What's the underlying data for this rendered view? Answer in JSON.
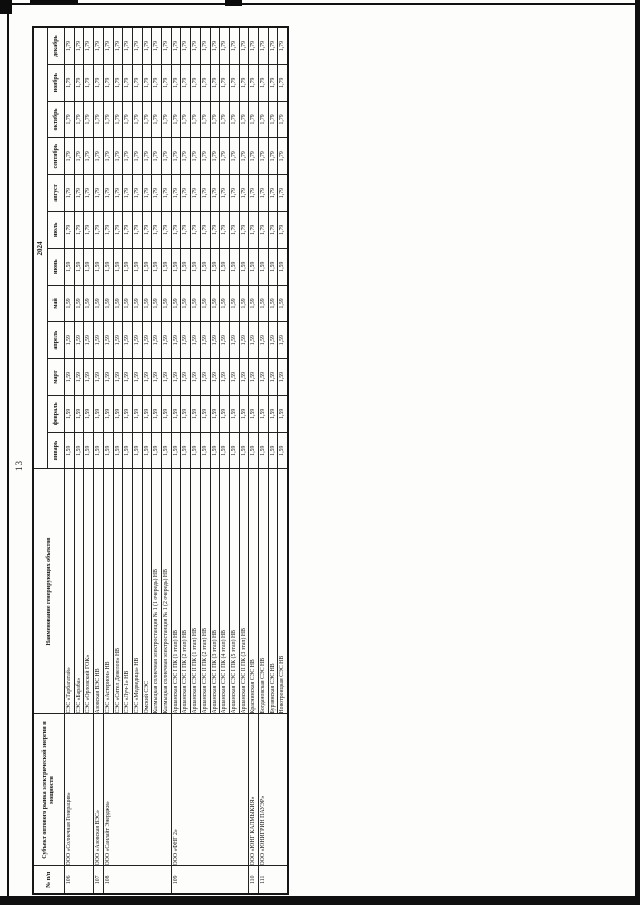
{
  "page": {
    "number": "13"
  },
  "table": {
    "year_header": "2024",
    "column_headers": {
      "num": "№ п/п",
      "subject": "Субъект оптового рынка электрической энергии и мощности",
      "object": "Наименование генерирующих объектов"
    },
    "months": [
      "январь",
      "февраль",
      "март",
      "апрель",
      "май",
      "июнь",
      "июль",
      "август",
      "сентябрь",
      "октябрь",
      "ноябрь",
      "декабрь"
    ],
    "groups": [
      {
        "no": "106",
        "subject": "ООО «Солнечная Генерация»",
        "objects": [
          {
            "name": "СЭС «Тарбагатай»",
            "values": [
              "1,59",
              "1,59",
              "1,59",
              "1,59",
              "1,59",
              "1,59",
              "1,79",
              "1,79",
              "1,79",
              "1,79",
              "1,79",
              "1,79"
            ]
          },
          {
            "name": "СЭС «Бараба»",
            "values": [
              "1,59",
              "1,59",
              "1,59",
              "1,59",
              "1,59",
              "1,59",
              "1,79",
              "1,79",
              "1,79",
              "1,79",
              "1,79",
              "1,79"
            ]
          },
          {
            "name": "СЭС «Орловский ГОК»",
            "values": [
              "1,59",
              "1,59",
              "1,59",
              "1,59",
              "1,59",
              "1,59",
              "1,79",
              "1,79",
              "1,79",
              "1,79",
              "1,79",
              "1,79"
            ]
          }
        ]
      },
      {
        "no": "107",
        "subject": "ООО «Азовская ВЭС»",
        "objects": [
          {
            "name": "Азовская ВЭС НВ",
            "values": [
              "1,59",
              "1,59",
              "1,59",
              "1,59",
              "1,59",
              "1,59",
              "1,79",
              "1,79",
              "1,79",
              "1,79",
              "1,79",
              "1,79"
            ]
          }
        ]
      },
      {
        "no": "108",
        "subject": "ООО «Санлайт Энерджи»",
        "objects": [
          {
            "name": "СЭС «Астерион» НВ",
            "values": [
              "1,59",
              "1,59",
              "1,59",
              "1,59",
              "1,59",
              "1,59",
              "1,79",
              "1,79",
              "1,79",
              "1,79",
              "1,79",
              "1,79"
            ]
          },
          {
            "name": "СЭС «Сител Девелоп» НВ",
            "values": [
              "1,59",
              "1,59",
              "1,59",
              "1,59",
              "1,59",
              "1,59",
              "1,79",
              "1,79",
              "1,79",
              "1,79",
              "1,79",
              "1,79"
            ]
          },
          {
            "name": "СЭС «Луч-1» НВ",
            "values": [
              "1,59",
              "1,59",
              "1,59",
              "1,59",
              "1,59",
              "1,59",
              "1,79",
              "1,79",
              "1,79",
              "1,79",
              "1,79",
              "1,79"
            ]
          },
          {
            "name": "СЭС «Медведица» НВ",
            "values": [
              "1,59",
              "1,59",
              "1,59",
              "1,59",
              "1,59",
              "1,59",
              "1,79",
              "1,79",
              "1,79",
              "1,79",
              "1,79",
              "1,79"
            ]
          },
          {
            "name": "Омский СЭС",
            "values": [
              "1,59",
              "1,59",
              "1,59",
              "1,59",
              "1,59",
              "1,59",
              "1,79",
              "1,79",
              "1,79",
              "1,79",
              "1,79",
              "1,79"
            ]
          },
          {
            "name": "Калмыцкая солнечная электростанция № 1 (1 очередь) НВ",
            "values": [
              "1,59",
              "1,59",
              "1,59",
              "1,59",
              "1,59",
              "1,59",
              "1,79",
              "1,79",
              "1,79",
              "1,79",
              "1,79",
              "1,79"
            ]
          },
          {
            "name": "Калмыцкая солнечная электростанция № 1 (2 очередь) НВ",
            "values": [
              "1,59",
              "1,59",
              "1,59",
              "1,59",
              "1,59",
              "1,59",
              "1,79",
              "1,79",
              "1,79",
              "1,79",
              "1,79",
              "1,79"
            ]
          }
        ]
      },
      {
        "no": "109",
        "subject": "ООО «ФНГ 2»",
        "objects": [
          {
            "name": "Аршанская СЭС I ПК (1 этап) НВ",
            "values": [
              "1,59",
              "1,59",
              "1,59",
              "1,59",
              "1,59",
              "1,59",
              "1,79",
              "1,79",
              "1,79",
              "1,79",
              "1,79",
              "1,79"
            ]
          },
          {
            "name": "Аршанская СЭС I ПК (2 этап) НВ",
            "values": [
              "1,59",
              "1,59",
              "1,59",
              "1,59",
              "1,59",
              "1,59",
              "1,79",
              "1,79",
              "1,79",
              "1,79",
              "1,79",
              "1,79"
            ]
          },
          {
            "name": "Аршанская СЭС II ПК (1 этап) НВ",
            "values": [
              "1,59",
              "1,59",
              "1,59",
              "1,59",
              "1,59",
              "1,59",
              "1,79",
              "1,79",
              "1,79",
              "1,79",
              "1,79",
              "1,79"
            ]
          },
          {
            "name": "Аршанская СЭС II ПК (2 этап) НВ",
            "values": [
              "1,59",
              "1,59",
              "1,59",
              "1,59",
              "1,59",
              "1,59",
              "1,79",
              "1,79",
              "1,79",
              "1,79",
              "1,79",
              "1,79"
            ]
          },
          {
            "name": "Аршанская СЭС I ПК (3 этап) НВ",
            "values": [
              "1,59",
              "1,59",
              "1,59",
              "1,59",
              "1,59",
              "1,59",
              "1,79",
              "1,79",
              "1,79",
              "1,79",
              "1,79",
              "1,79"
            ]
          },
          {
            "name": "Аршанская СЭС I ПК (4 этап) НВ",
            "values": [
              "1,59",
              "1,59",
              "1,59",
              "1,59",
              "1,59",
              "1,59",
              "1,79",
              "1,79",
              "1,79",
              "1,79",
              "1,79",
              "1,79"
            ]
          },
          {
            "name": "Аршанская СЭС I ПК (5 этап) НВ",
            "values": [
              "1,59",
              "1,59",
              "1,59",
              "1,59",
              "1,59",
              "1,59",
              "1,79",
              "1,79",
              "1,79",
              "1,79",
              "1,79",
              "1,79"
            ]
          },
          {
            "name": "Аршанская СЭС II ПК (3 этап) НВ",
            "values": [
              "1,59",
              "1,59",
              "1,59",
              "1,59",
              "1,59",
              "1,59",
              "1,79",
              "1,79",
              "1,79",
              "1,79",
              "1,79",
              "1,79"
            ]
          }
        ]
      },
      {
        "no": "110",
        "subject": "ООО «ЮНГ КАЛМЫКИЯ»",
        "objects": [
          {
            "name": "Краснинская СЭС НВ",
            "values": [
              "1,59",
              "1,59",
              "1,59",
              "1,59",
              "1,59",
              "1,59",
              "1,79",
              "1,79",
              "1,79",
              "1,79",
              "1,79",
              "1,79"
            ]
          }
        ]
      },
      {
        "no": "111",
        "subject": "ООО «ЮНИГРИН ПАУЭР»",
        "objects": [
          {
            "name": "Богдановская СЭС НВ",
            "values": [
              "1,59",
              "1,59",
              "1,59",
              "1,59",
              "1,59",
              "1,59",
              "1,79",
              "1,79",
              "1,79",
              "1,79",
              "1,79",
              "1,79"
            ]
          },
          {
            "name": "Бурзянская СЭС НВ",
            "values": [
              "1,59",
              "1,59",
              "1,59",
              "1,59",
              "1,59",
              "1,59",
              "1,79",
              "1,79",
              "1,79",
              "1,79",
              "1,79",
              "1,79"
            ]
          },
          {
            "name": "Новотроицкая СЭС НВ",
            "values": [
              "1,59",
              "1,59",
              "1,59",
              "1,59",
              "1,59",
              "1,59",
              "1,79",
              "1,79",
              "1,79",
              "1,79",
              "1,79",
              "1,79"
            ]
          }
        ]
      }
    ]
  }
}
